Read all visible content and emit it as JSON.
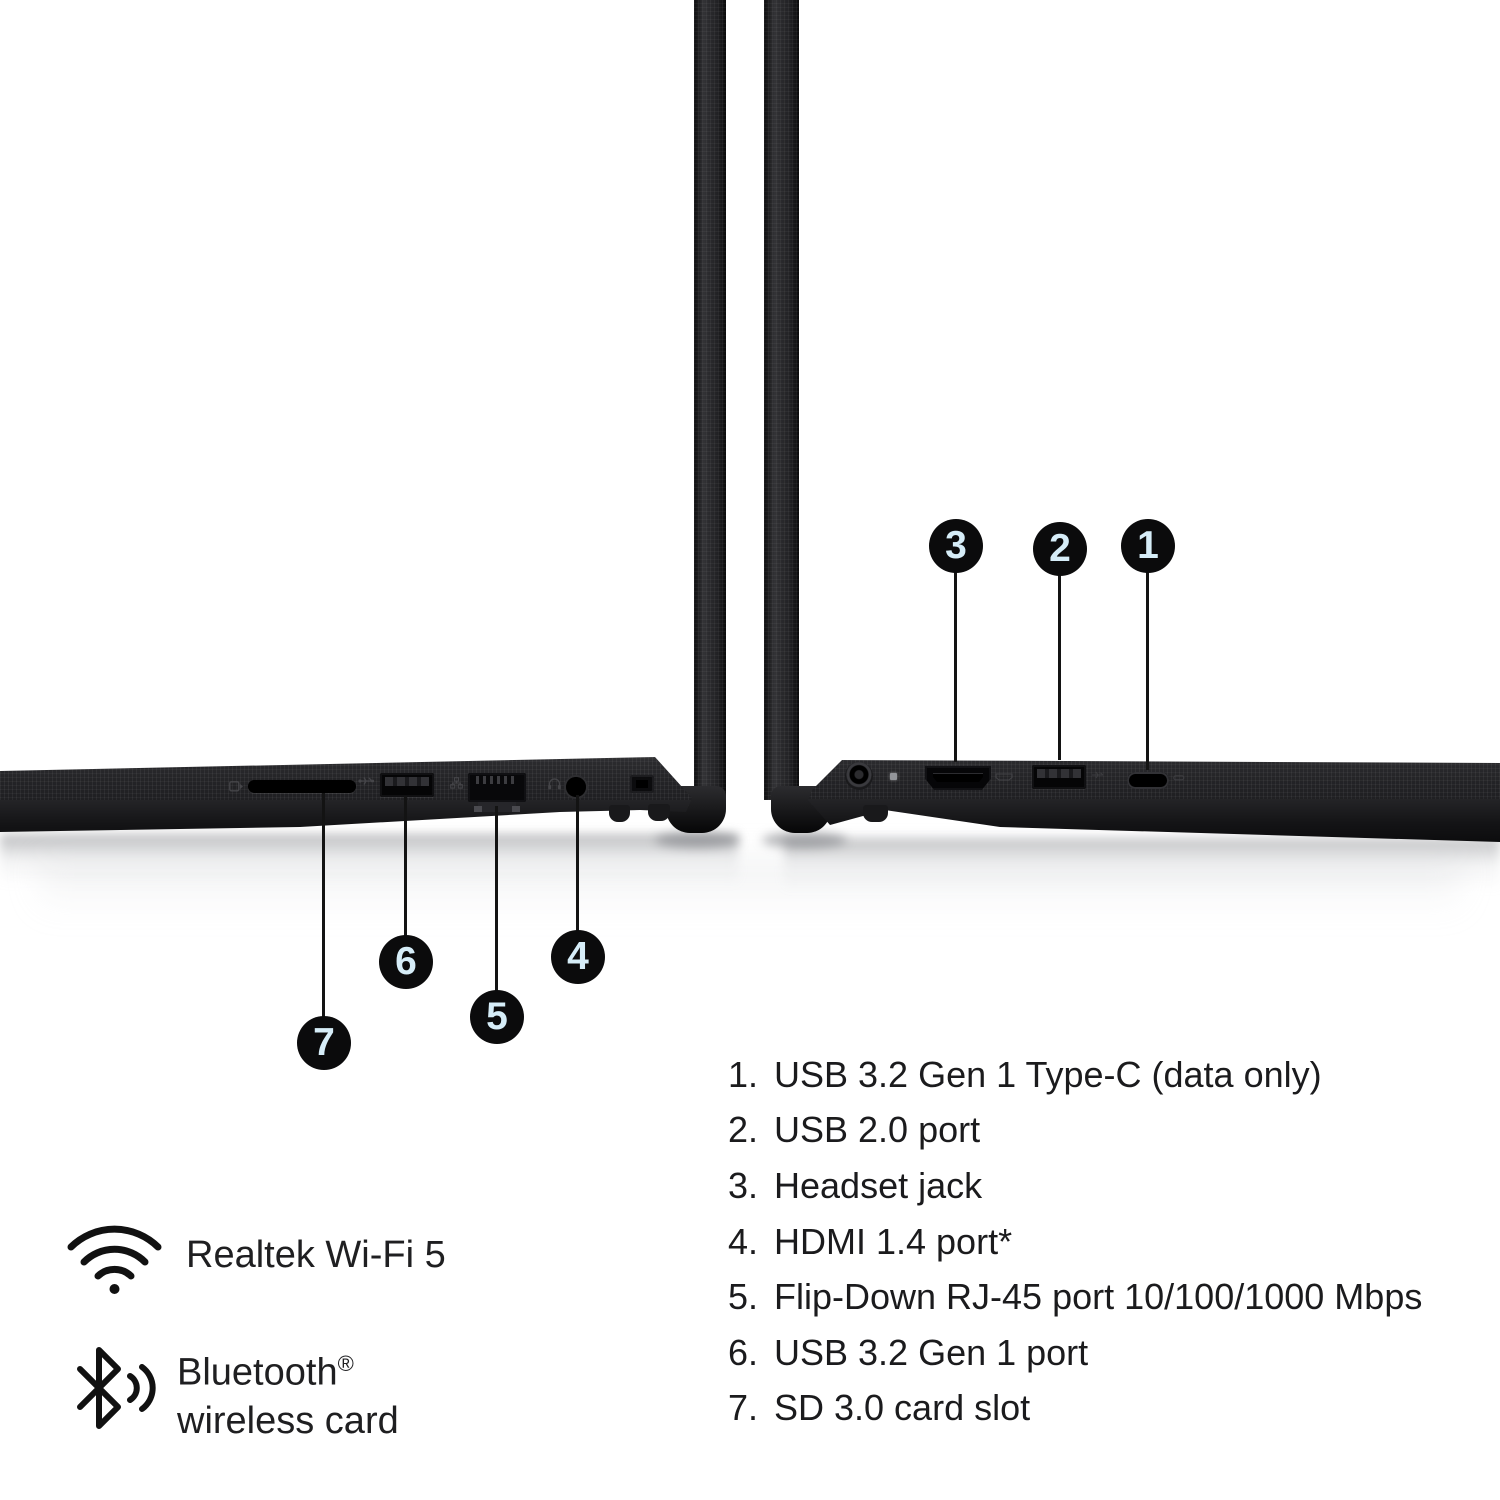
{
  "image": {
    "description": "Two edge-on laptop side views with numbered port callouts, a numbered port legend, and wireless feature icons",
    "background_color": "#ffffff"
  },
  "colors": {
    "laptop_black": "#222225",
    "callout_circle": "#0b0b0c",
    "callout_number": "#d6edf8",
    "text": "#1b1b1d"
  },
  "callouts": {
    "right_view": [
      {
        "number": "3",
        "points_to": "hdmi-port"
      },
      {
        "number": "2",
        "points_to": "usb-a-port"
      },
      {
        "number": "1",
        "points_to": "usb-c-port"
      }
    ],
    "left_view": [
      {
        "number": "7",
        "points_to": "sd-card-slot"
      },
      {
        "number": "6",
        "points_to": "usb-a-port"
      },
      {
        "number": "5",
        "points_to": "rj45-port"
      },
      {
        "number": "4",
        "points_to": "headset-jack"
      }
    ]
  },
  "ports": {
    "left_view_icons": [
      "sd-card-icon",
      "usb-icon",
      "network-icon",
      "headset-icon",
      "lock-slot"
    ],
    "right_view_icons": [
      "power-jack",
      "status-led",
      "hdmi-icon",
      "usb-ss-icon",
      "usb-c-icon"
    ]
  },
  "legend": {
    "items": [
      {
        "number": "1.",
        "label": "USB 3.2 Gen 1 Type-C (data only)"
      },
      {
        "number": "2.",
        "label": "USB 2.0 port"
      },
      {
        "number": "3.",
        "label": "Headset jack"
      },
      {
        "number": "4.",
        "label": "HDMI 1.4 port*"
      },
      {
        "number": "5.",
        "label": "Flip-Down RJ-45 port 10/100/1000 Mbps"
      },
      {
        "number": "6.",
        "label": "USB 3.2 Gen 1 port"
      },
      {
        "number": "7.",
        "label": "SD 3.0 card slot"
      }
    ]
  },
  "connectivity": {
    "wifi": {
      "icon": "wifi-icon",
      "label": "Realtek Wi-Fi 5"
    },
    "bluetooth": {
      "icon": "bluetooth-icon",
      "label_line1": "Bluetooth",
      "registered_mark": "®",
      "label_line2": "wireless card"
    }
  }
}
